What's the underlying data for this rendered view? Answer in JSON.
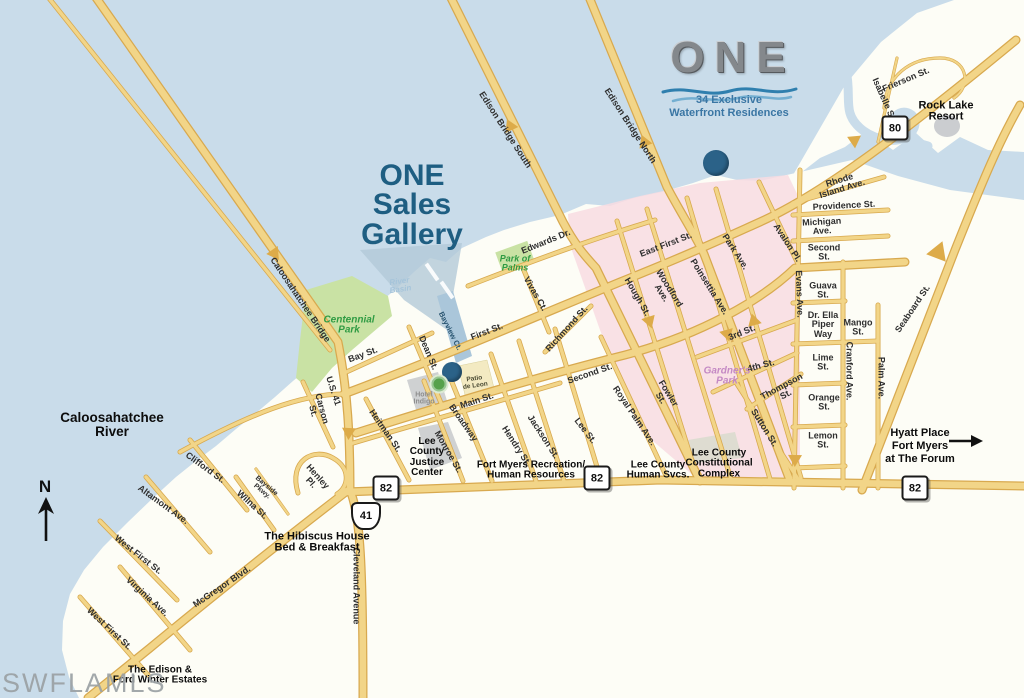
{
  "map": {
    "branding": {
      "logo": "ONE",
      "tagline1": "34 Exclusive",
      "tagline2": "Waterfront Residences"
    },
    "title": {
      "l1": "ONE",
      "l2": "Sales",
      "l3": "Gallery"
    },
    "hyatt": {
      "l1": "Hyatt Place",
      "l2": "Fort Myers",
      "l3": "at The Forum"
    },
    "north_indicator": "N",
    "watermark": "SWFLAMLS",
    "colors": {
      "water": "#c9dcea",
      "land": "#fdfdf6",
      "road": "#f2d588",
      "road_casing": "#d8a94f",
      "district_pink": "#f8dce2",
      "park_green": "#c9e2a4",
      "marker_blue": "#2b6288",
      "title_teal": "#1e5e82",
      "park_text_green": "#2f9b43",
      "gardner_pink": "#c489c4"
    },
    "route_badges": [
      {
        "sys": "FL",
        "label": "80",
        "x": 895,
        "y": 128
      },
      {
        "sys": "FL",
        "label": "82",
        "x": 386,
        "y": 488
      },
      {
        "sys": "FL",
        "label": "82",
        "x": 597,
        "y": 478
      },
      {
        "sys": "FL",
        "label": "82",
        "x": 915,
        "y": 488
      },
      {
        "sys": "US",
        "label": "41",
        "x": 366,
        "y": 516
      }
    ],
    "markers": [
      {
        "n": "one-residences-site",
        "x": 716,
        "y": 163,
        "d": 26,
        "k": "blue"
      },
      {
        "n": "one-sales-gallery",
        "x": 452,
        "y": 372,
        "d": 20,
        "k": "blue"
      },
      {
        "n": "hotel-indigo",
        "x": 439,
        "y": 384,
        "d": 15,
        "k": "green"
      }
    ],
    "labels": [
      {
        "t": "Frierson St.",
        "x": 906,
        "y": 80,
        "r": -23,
        "c": "st"
      },
      {
        "t": "Isabelle St.",
        "x": 884,
        "y": 100,
        "r": 66,
        "c": "st"
      },
      {
        "t": "Rock Lake\nResort",
        "x": 946,
        "y": 112,
        "r": 0,
        "c": "poi poi-lg"
      },
      {
        "t": "Seaboard St.",
        "x": 913,
        "y": 309,
        "r": -56,
        "c": "st"
      },
      {
        "t": "Rhode\nIsland Ave.",
        "x": 841,
        "y": 185,
        "r": -17,
        "c": "st"
      },
      {
        "t": "Providence St.",
        "x": 844,
        "y": 206,
        "r": -3,
        "c": "st"
      },
      {
        "t": "Michigan\nAve.",
        "x": 822,
        "y": 227,
        "r": -3,
        "c": "st"
      },
      {
        "t": "Second\nSt.",
        "x": 824,
        "y": 253,
        "r": 0,
        "c": "st"
      },
      {
        "t": "Guava\nSt.",
        "x": 823,
        "y": 291,
        "r": 0,
        "c": "st"
      },
      {
        "t": "Dr. Ella\nPiper\nWay",
        "x": 823,
        "y": 325,
        "r": 0,
        "c": "st"
      },
      {
        "t": "Mango\nSt.",
        "x": 858,
        "y": 328,
        "r": 0,
        "c": "st"
      },
      {
        "t": "Lime\nSt.",
        "x": 823,
        "y": 363,
        "r": 0,
        "c": "st"
      },
      {
        "t": "Cranford Ave.",
        "x": 849,
        "y": 371,
        "r": 90,
        "c": "st"
      },
      {
        "t": "Palm Ave.",
        "x": 881,
        "y": 378,
        "r": 90,
        "c": "st"
      },
      {
        "t": "Orange\nSt.",
        "x": 824,
        "y": 403,
        "r": 0,
        "c": "st"
      },
      {
        "t": "Lemon\nSt.",
        "x": 823,
        "y": 441,
        "r": 0,
        "c": "st"
      },
      {
        "t": "Evans Ave.",
        "x": 799,
        "y": 294,
        "r": 88,
        "c": "st"
      },
      {
        "t": "Avalon Pl.",
        "x": 787,
        "y": 243,
        "r": 57,
        "c": "st"
      },
      {
        "t": "Park Ave.",
        "x": 735,
        "y": 252,
        "r": 57,
        "c": "st"
      },
      {
        "t": "Poinsettia Ave.",
        "x": 709,
        "y": 287,
        "r": 58,
        "c": "st"
      },
      {
        "t": "Woodford\nAve.",
        "x": 665,
        "y": 291,
        "r": 58,
        "c": "st"
      },
      {
        "t": "East First St.",
        "x": 666,
        "y": 245,
        "r": -21,
        "c": "st"
      },
      {
        "t": "Hough St.",
        "x": 637,
        "y": 297,
        "r": 60,
        "c": "st"
      },
      {
        "t": "3rd St.",
        "x": 742,
        "y": 333,
        "r": -22,
        "c": "st"
      },
      {
        "t": "4th St.",
        "x": 761,
        "y": 366,
        "r": -15,
        "c": "st"
      },
      {
        "t": "Thompson\nSt.",
        "x": 784,
        "y": 391,
        "r": -28,
        "c": "st"
      },
      {
        "t": "Sutton St.",
        "x": 764,
        "y": 428,
        "r": 58,
        "c": "st"
      },
      {
        "t": "Gardner's\nPark",
        "x": 727,
        "y": 377,
        "r": 0,
        "c": "park park-pink"
      },
      {
        "t": "Fowler\nSt.",
        "x": 664,
        "y": 396,
        "r": 58,
        "c": "st"
      },
      {
        "t": "Royal Palm Ave.",
        "x": 634,
        "y": 416,
        "r": 56,
        "c": "st"
      },
      {
        "t": "Lee St.",
        "x": 585,
        "y": 431,
        "r": 52,
        "c": "st"
      },
      {
        "t": "Second St.",
        "x": 590,
        "y": 374,
        "r": -19,
        "c": "st"
      },
      {
        "t": "Richmond St.",
        "x": 567,
        "y": 329,
        "r": -48,
        "c": "st"
      },
      {
        "t": "Jackson St.",
        "x": 543,
        "y": 437,
        "r": 57,
        "c": "st"
      },
      {
        "t": "Hendry St.",
        "x": 516,
        "y": 446,
        "r": 57,
        "c": "st"
      },
      {
        "t": "Broadway",
        "x": 463,
        "y": 423,
        "r": 55,
        "c": "st"
      },
      {
        "t": "Monroe St.",
        "x": 448,
        "y": 452,
        "r": 60,
        "c": "st"
      },
      {
        "t": "Heitman St.",
        "x": 385,
        "y": 431,
        "r": 55,
        "c": "st"
      },
      {
        "t": "Main St.",
        "x": 477,
        "y": 401,
        "r": -18,
        "c": "st"
      },
      {
        "t": "First St.",
        "x": 487,
        "y": 332,
        "r": -21,
        "c": "st"
      },
      {
        "t": "Bay St.",
        "x": 363,
        "y": 355,
        "r": -20,
        "c": "st"
      },
      {
        "t": "Dean St.",
        "x": 428,
        "y": 353,
        "r": 67,
        "c": "st"
      },
      {
        "t": "Bayview Ct.",
        "x": 450,
        "y": 331,
        "r": 63,
        "c": "st st-navy"
      },
      {
        "t": "Vivas Ct.",
        "x": 535,
        "y": 294,
        "r": 60,
        "c": "st"
      },
      {
        "t": "Edwards Dr.",
        "x": 546,
        "y": 242,
        "r": -22,
        "c": "st"
      },
      {
        "t": "Edison Bridge South",
        "x": 505,
        "y": 130,
        "r": 57,
        "c": "st"
      },
      {
        "t": "Edison Bridge North",
        "x": 630,
        "y": 126,
        "r": 57,
        "c": "st"
      },
      {
        "t": "Caloosahatchee Bridge",
        "x": 300,
        "y": 300,
        "r": 56,
        "c": "st"
      },
      {
        "t": "U.S. 41",
        "x": 333,
        "y": 391,
        "r": 72,
        "c": "st"
      },
      {
        "t": "Carson\nSt.",
        "x": 317,
        "y": 410,
        "r": 75,
        "c": "st"
      },
      {
        "t": "Cleveland Avenue",
        "x": 356,
        "y": 586,
        "r": 90,
        "c": "st"
      },
      {
        "t": "McGregor Blvd.",
        "x": 222,
        "y": 587,
        "r": -34,
        "c": "st"
      },
      {
        "t": "Henley\nPl.",
        "x": 314,
        "y": 480,
        "r": 48,
        "c": "st"
      },
      {
        "t": "Bayside\nPkwy.",
        "x": 264,
        "y": 489,
        "r": 40,
        "c": "st st-sm"
      },
      {
        "t": "Wilna St.",
        "x": 252,
        "y": 505,
        "r": 42,
        "c": "st"
      },
      {
        "t": "Clifford St.",
        "x": 205,
        "y": 468,
        "r": 36,
        "c": "st"
      },
      {
        "t": "Altamont Ave.",
        "x": 163,
        "y": 505,
        "r": 36,
        "c": "st"
      },
      {
        "t": "West First St.",
        "x": 138,
        "y": 555,
        "r": 38,
        "c": "st"
      },
      {
        "t": "Virginia Ave.",
        "x": 147,
        "y": 597,
        "r": 42,
        "c": "st"
      },
      {
        "t": "West First St.",
        "x": 109,
        "y": 629,
        "r": 43,
        "c": "st"
      },
      {
        "t": "Centennial\nPark",
        "x": 349,
        "y": 326,
        "r": 0,
        "c": "park"
      },
      {
        "t": "Park of\nPalms",
        "x": 515,
        "y": 264,
        "r": 0,
        "c": "park park-sm"
      },
      {
        "t": "River\nBasin",
        "x": 400,
        "y": 286,
        "r": -8,
        "c": "water-faint"
      },
      {
        "t": "Caloosahatchee\nRiver",
        "x": 112,
        "y": 425,
        "r": 0,
        "c": "river"
      },
      {
        "t": "Hotel\nIndigo",
        "x": 424,
        "y": 399,
        "r": 0,
        "c": "hotel"
      },
      {
        "t": "Patio\nde Leon",
        "x": 475,
        "y": 383,
        "r": -8,
        "c": "tiny-dark"
      },
      {
        "t": "Lee\nCounty\nJustice\nCenter",
        "x": 427,
        "y": 458,
        "r": 0,
        "c": "poi"
      },
      {
        "t": "Fort Myers Recreation/\nHuman Resources",
        "x": 531,
        "y": 471,
        "r": 0,
        "c": "poi"
      },
      {
        "t": "Lee County\nHuman Svcs.",
        "x": 658,
        "y": 471,
        "r": 0,
        "c": "poi"
      },
      {
        "t": "Lee County\nConstitutional\nComplex",
        "x": 719,
        "y": 464,
        "r": 0,
        "c": "poi"
      },
      {
        "t": "The Hibiscus House\nBed & Breakfast",
        "x": 317,
        "y": 543,
        "r": 0,
        "c": "poi poi-lg"
      },
      {
        "t": "The Edison &\nFord Winter Estates",
        "x": 160,
        "y": 676,
        "r": 0,
        "c": "poi"
      }
    ]
  }
}
